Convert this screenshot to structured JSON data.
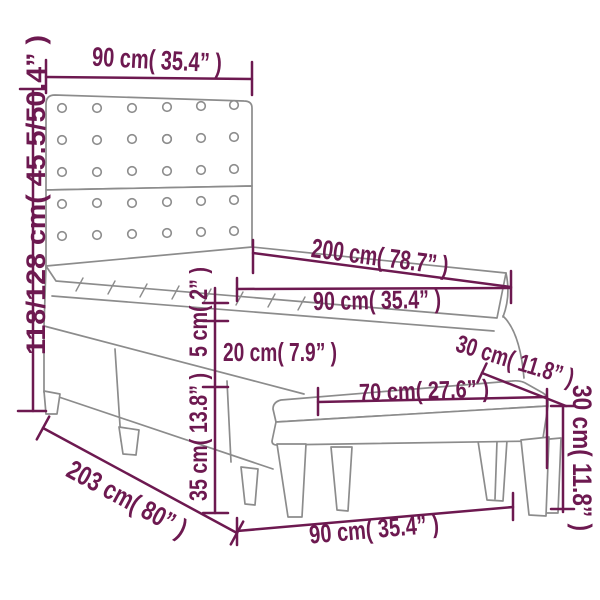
{
  "diagram": {
    "kind": "product-dimension-diagram",
    "subject": "box spring bed with headboard, mattress topper and bench",
    "colors": {
      "dimension_accent": "#6d1950",
      "furniture_line": "#8c8c8c",
      "background": "#ffffff"
    },
    "dimensions": {
      "headboard_width": "90 cm( 35.4” )",
      "height_range": "118/128 cm( 45.5/50.4” )",
      "mattress_length": "200 cm( 78.7” )",
      "mattress_width": "90 cm( 35.4” )",
      "topper_thickness": "5 cm( 2” )",
      "mattress_thickness": "20 cm( 7.9” )",
      "base_height": "35 cm( 13.8” )",
      "bed_length": "203 cm( 80” )",
      "bench_length": "70 cm( 27.6” )",
      "bench_depth": "30 cm( 11.8” )",
      "bench_height": "30 cm( 11.8” )",
      "bed_width_bottom": "90 cm( 35.4” )"
    }
  }
}
